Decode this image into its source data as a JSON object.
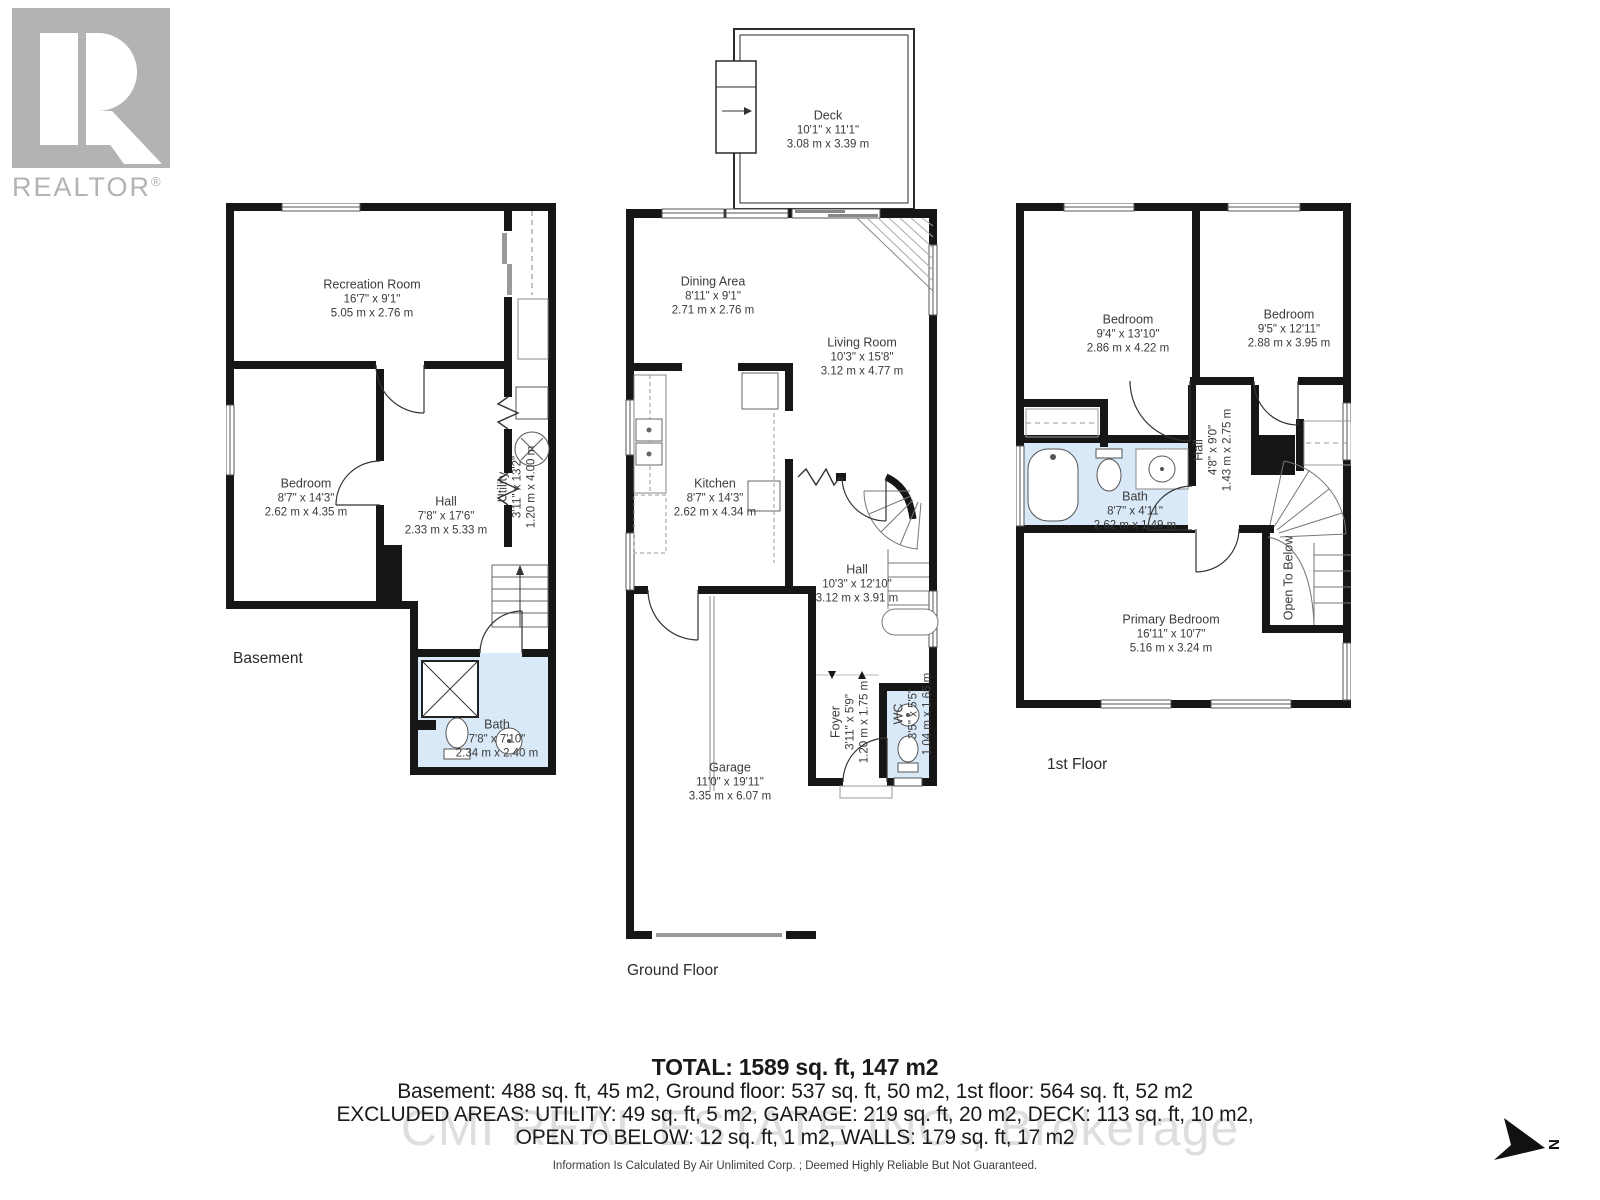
{
  "logo": {
    "brand": "REALTOR",
    "registered": "®"
  },
  "compass": {
    "label": "N"
  },
  "colors": {
    "wall": "#161616",
    "bath_fill": "#d9e9f7",
    "logo_gray": "#b3b3b3",
    "watermark_gray": "#c9c9c9"
  },
  "floors": {
    "basement": {
      "label": "Basement",
      "rooms": {
        "recreation": {
          "name": "Recreation Room",
          "imperial": "16'7\" x 9'1\"",
          "metric": "5.05 m x 2.76 m"
        },
        "bedroom": {
          "name": "Bedroom",
          "imperial": "8'7\" x 14'3\"",
          "metric": "2.62 m x 4.35 m"
        },
        "hall": {
          "name": "Hall",
          "imperial": "7'8\" x 17'6\"",
          "metric": "2.33 m x 5.33 m"
        },
        "utility": {
          "name": "Utility",
          "imperial": "3'11\" x 13'2\"",
          "metric": "1.20 m x 4.00 m"
        },
        "bath": {
          "name": "Bath",
          "imperial": "7'8\" x 7'10\"",
          "metric": "2.34 m x 2.40 m"
        }
      }
    },
    "ground": {
      "label": "Ground Floor",
      "rooms": {
        "deck": {
          "name": "Deck",
          "imperial": "10'1\" x 11'1\"",
          "metric": "3.08 m x 3.39 m"
        },
        "dining": {
          "name": "Dining Area",
          "imperial": "8'11\" x 9'1\"",
          "metric": "2.71 m x 2.76 m"
        },
        "living": {
          "name": "Living Room",
          "imperial": "10'3\" x 15'8\"",
          "metric": "3.12 m x 4.77 m"
        },
        "kitchen": {
          "name": "Kitchen",
          "imperial": "8'7\" x 14'3\"",
          "metric": "2.62 m x 4.34 m"
        },
        "hall": {
          "name": "Hall",
          "imperial": "10'3\" x 12'10\"",
          "metric": "3.12 m x 3.91 m"
        },
        "garage": {
          "name": "Garage",
          "imperial": "11'0\" x 19'11\"",
          "metric": "3.35 m x 6.07 m"
        },
        "foyer": {
          "name": "Foyer",
          "imperial": "3'11\" x 5'9\"",
          "metric": "1.20 m x 1.75 m"
        },
        "wc": {
          "name": "WC",
          "imperial": "3'5\" x 5'5\"",
          "metric": "1.04 m x 1.65 m"
        }
      }
    },
    "first": {
      "label": "1st Floor",
      "rooms": {
        "bedroom_left": {
          "name": "Bedroom",
          "imperial": "9'4\" x 13'10\"",
          "metric": "2.86 m x 4.22 m"
        },
        "bedroom_right": {
          "name": "Bedroom",
          "imperial": "9'5\" x 12'11\"",
          "metric": "2.88 m x 3.95 m"
        },
        "hall": {
          "name": "Hall",
          "imperial": "4'8\" x 9'0\"",
          "metric": "1.43 m x 2.75 m"
        },
        "bath": {
          "name": "Bath",
          "imperial": "8'7\" x 4'11\"",
          "metric": "2.62 m x 1.49 m"
        },
        "primary": {
          "name": "Primary Bedroom",
          "imperial": "16'11\" x 10'7\"",
          "metric": "5.16 m x 3.24 m"
        },
        "open_below": {
          "name": "Open To Below"
        }
      }
    }
  },
  "summary": {
    "total": "TOTAL: 1589 sq. ft, 147 m2",
    "line1": "Basement: 488 sq. ft, 45 m2, Ground floor: 537 sq. ft, 50 m2, 1st floor: 564 sq. ft, 52 m2",
    "line2": "EXCLUDED AREAS: UTILITY: 49 sq. ft, 5 m2, GARAGE: 219 sq. ft, 20 m2, DECK: 113 sq. ft, 10 m2,",
    "line3": "OPEN TO BELOW: 12 sq. ft, 1 m2, WALLS: 179 sq. ft, 17 m2",
    "disclaimer": "Information Is Calculated By Air Unlimited Corp. ; Deemed Highly Reliable But Not Guaranteed."
  },
  "watermark": "CMI REAL ESTATE INC., Brokerage"
}
